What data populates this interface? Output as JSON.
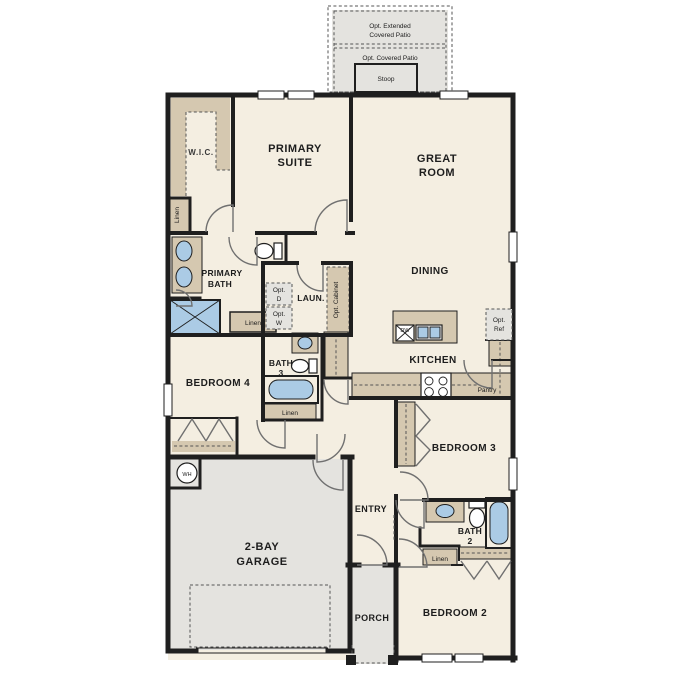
{
  "plan": {
    "outdoor": {
      "opt_extended_patio_1": "Opt. Extended",
      "opt_extended_patio_2": "Covered Patio",
      "opt_covered_patio": "Opt. Covered Patio",
      "stoop": "Stoop",
      "porch": "PORCH"
    },
    "rooms": {
      "wic": "W.I.C.",
      "primary_suite_1": "PRIMARY",
      "primary_suite_2": "SUITE",
      "great_room_1": "GREAT",
      "great_room_2": "ROOM",
      "dining": "DINING",
      "primary_bath_1": "PRIMARY",
      "primary_bath_2": "BATH",
      "laundry": "LAUN.",
      "bath3_1": "BATH",
      "bath3_2": "3",
      "bedroom4": "BEDROOM 4",
      "kitchen": "KITCHEN",
      "bedroom3": "BEDROOM 3",
      "entry": "ENTRY",
      "bath2_1": "BATH",
      "bath2_2": "2",
      "bedroom2": "BEDROOM 2",
      "garage_1": "2-BAY",
      "garage_2": "GARAGE"
    },
    "closets": {
      "linen_primary": "Linen",
      "linen_bath": "Linen",
      "linen_bath3": "Linen",
      "linen_bath2": "Linen",
      "pantry": "Pantry"
    },
    "optional_items": {
      "opt_dryer_1": "Opt.",
      "opt_dryer_2": "D",
      "opt_washer_1": "Opt.",
      "opt_washer_2": "W",
      "opt_cabinet": "Opt. Cabinet",
      "opt_ref_1": "Opt.",
      "opt_ref_2": "Ref"
    },
    "appliances": {
      "dishwasher": "DW",
      "water_heater": "WH"
    },
    "colors": {
      "wall": "#1f1f1f",
      "room_fill": "#f4eee1",
      "outdoor_fill": "#e4e3df",
      "cabinet_fill": "#d5c8b0",
      "fixture_fill": "#abcbe5",
      "door_stroke": "#707070",
      "text": "#1d1d1d"
    }
  }
}
